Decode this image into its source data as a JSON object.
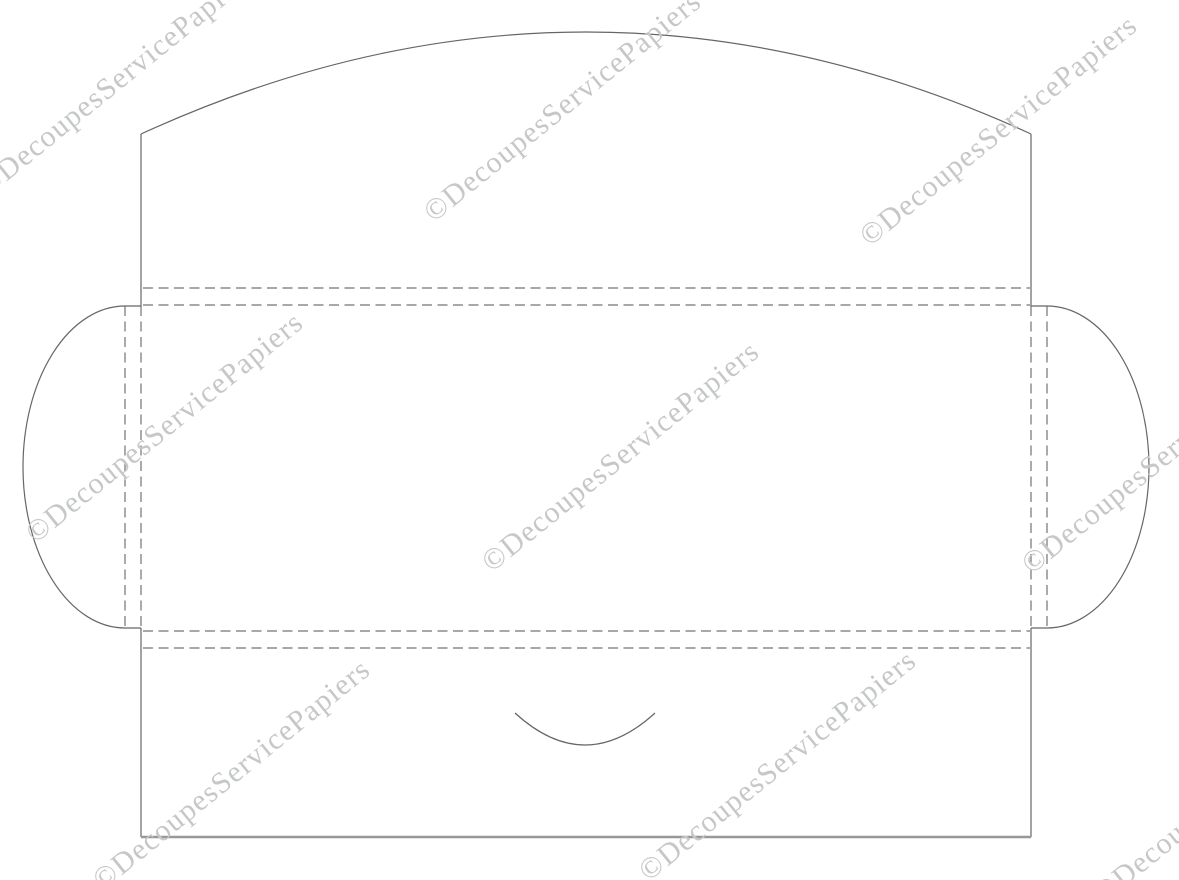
{
  "page": {
    "description": "Envelope template dieline with cut lines, dashed fold guides and repeated diagonal copyright watermarks",
    "background": "#ffffff",
    "canvas": {
      "width": 1179,
      "height": 880
    }
  },
  "colors": {
    "cut_line": "#666666",
    "fold_line": "#737373",
    "bottom_edge": "#989898",
    "watermark": "#c6c8c8",
    "background": "#ffffff"
  },
  "watermark": {
    "text": "©DecoupesServicePapiers",
    "color": "#c6c8c8",
    "angle_deg": -39,
    "font_size_px": 30,
    "instances": [
      {
        "css": "left:-18px;top:171px"
      },
      {
        "css": "left:428px;top:197px"
      },
      {
        "css": "left:864px;top:221px"
      },
      {
        "css": "left:30px;top:518px"
      },
      {
        "css": "left:486px;top:547px"
      },
      {
        "css": "left:1026px;top:549px"
      },
      {
        "css": "left:97px;top:865px"
      },
      {
        "css": "left:643px;top:856px"
      },
      {
        "css": "left:1098px;top:878px"
      }
    ]
  },
  "geometry": {
    "body_rect": {
      "left": 141,
      "right": 1031,
      "top": 305,
      "bottom": 631
    },
    "top_flap": {
      "corner_y": 134,
      "arc_apex_y": 32
    },
    "side_flaps": {
      "fold_x_left": 125,
      "fold_x_right": 1047,
      "radius_x": 102,
      "top_y": 306,
      "bottom_y": 628
    },
    "bottom_flap": {
      "bottom_y": 837,
      "thumb_notch": {
        "from_x": 515,
        "to_x": 655,
        "edge_y": 713,
        "depth": 32
      }
    },
    "fold_strip_ys": [
      288,
      305,
      631,
      648
    ]
  },
  "paths": {
    "cut_outline": "M 141,134 Q 586,-70 1031,134 M 141,134 L 141,306 M 1031,134 L 1031,306 M 125,306 L 141,306 M 1047,306 L 1031,306 M 125,306 A 102,161 0 0 0 125,628 M 1047,306 A 102,161 0 0 1 1047,628 M 125,628 L 141,628 M 1047,628 L 1031,628 M 141,628 L 141,837 M 1031,628 L 1031,837",
    "thumb_notch": "M 515,713 Q 585,777 655,713",
    "bottom_edge": "M 141,837 L 1031,837",
    "fold_lines": "M 143,288 L 1030,288 M 143,305 L 1030,305 M 143,631 L 1030,631 M 143,648 L 1030,648 M 125,306 L 125,628 M 141,306 L 141,628 M 1031,306 L 1031,628 M 1047,306 L 1047,628"
  }
}
